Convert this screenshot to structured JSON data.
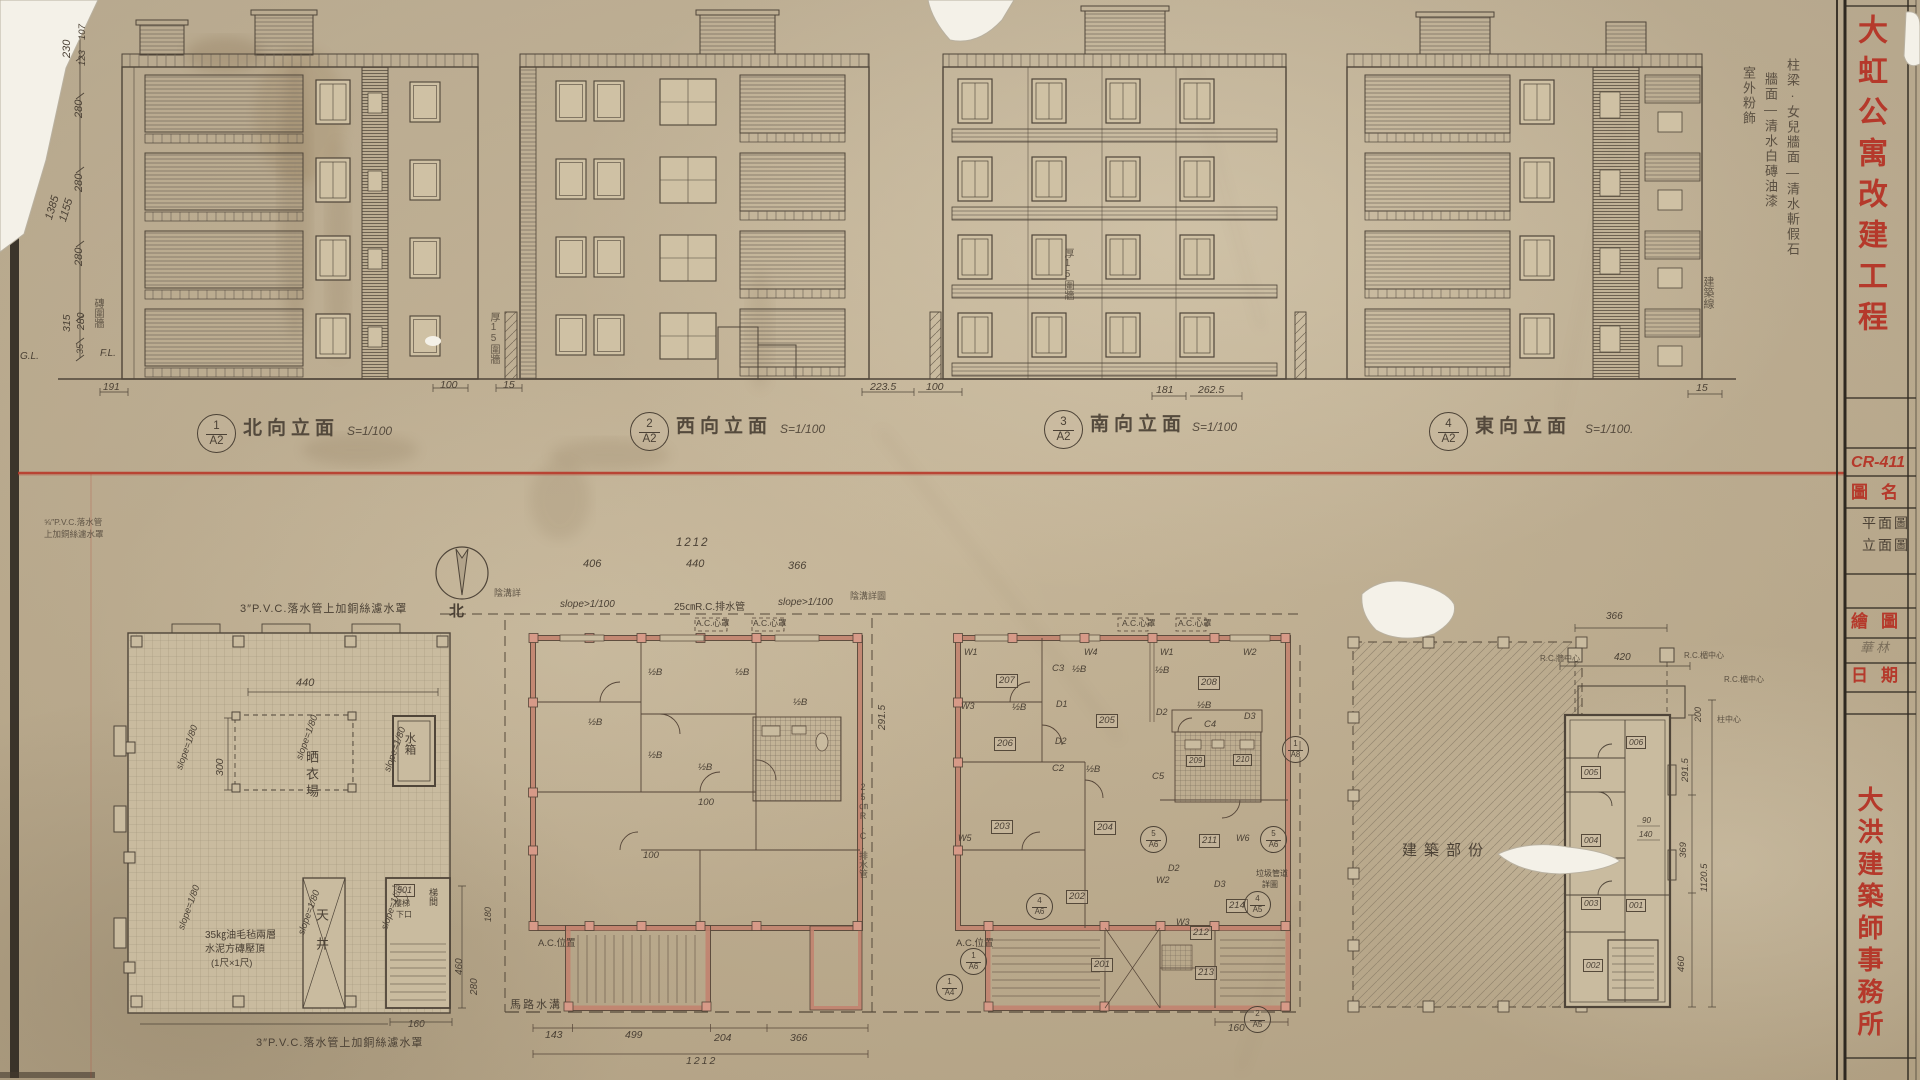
{
  "sheet": {
    "project_title": "大虹公寓改建工程",
    "firm_name": "大洪建築師事務所",
    "sheet_no": "CR-411",
    "title_block": {
      "drawing_name_label": "圖名",
      "drawing_name_line1": "平面圖",
      "drawing_name_line2": "立面圖",
      "drawn_by_label": "繪圖",
      "drawn_by_value": "華林",
      "date_label": "日期"
    }
  },
  "finish_note": {
    "col1": "柱梁·女兒牆面—清水斬假石",
    "col2": "牆面—清水白磚油漆",
    "col3": "室外粉飾"
  },
  "elevations": {
    "labels": [
      {
        "no": "1",
        "sheet": "A2",
        "title": "北向立面",
        "scale": "S=1/100"
      },
      {
        "no": "2",
        "sheet": "A2",
        "title": "西向立面",
        "scale": "S=1/100"
      },
      {
        "no": "3",
        "sheet": "A2",
        "title": "南向立面",
        "scale": "S=1/100"
      },
      {
        "no": "4",
        "sheet": "A2",
        "title": "東向立面",
        "scale": "S=1/100."
      }
    ],
    "left_dims": {
      "d230": "230",
      "d107": "107",
      "d123": "123",
      "d280": "280",
      "d1385": "1385",
      "d1155": "1155",
      "d315": "315",
      "d35": "35",
      "gl": "G.L.",
      "fl": "F.L.",
      "brick_wall": "磚圍牆",
      "d191": "191"
    },
    "ground_dims": {
      "d100": "100",
      "d15": "15",
      "d2235": "223.5",
      "d100b": "100",
      "d181": "181",
      "d2625": "262.5",
      "d15b": "15"
    },
    "notes": {
      "wall15": "厚15圍牆",
      "building_line": "建築線"
    }
  },
  "roof_plan": {
    "pvc_note": "3″P.V.C.落水管上加銅絲濾水罩",
    "pvc_note_s1": "⅝″P.V.C.落水管",
    "pvc_note_s2": "上加銅絲濾水罩",
    "slope": "slope=1/80",
    "d440": "440",
    "d300": "300",
    "d460": "460",
    "d280": "280",
    "d180": "180",
    "d160": "160",
    "drying": "晒衣場",
    "tank": "水箱",
    "lightwell": "天井",
    "stair_no": "501",
    "stair1": "樓梯",
    "stair2": "下口",
    "stair_room": "梯間",
    "note1": "35㎏油毛毡兩層",
    "note2": "水泥方磚壓頂",
    "note3": "(1尺×1尺)"
  },
  "plan_typ": {
    "north": "北",
    "d1212": "1212",
    "d406": "406",
    "d440": "440",
    "d366": "366",
    "slope": "slope>1/100",
    "drain": "25㎝R.C.排水管",
    "gutter": "陰溝詳圖",
    "gutter_s": "陰溝詳",
    "ac_hood": "A.C.心罩",
    "ac_pos": "A.C.位置",
    "half_b": "½B",
    "d100": "100",
    "road": "馬路水溝",
    "d143": "143",
    "d499": "499",
    "d204": "204",
    "d366b": "366",
    "d1212b": "1212",
    "d2915": "291.5"
  },
  "plan_unit": {
    "rooms": {
      "r201": "201",
      "r202": "202",
      "r203": "203",
      "r204": "204",
      "r205": "205",
      "r206": "206",
      "r207": "207",
      "r208": "208",
      "r209": "209",
      "r210": "210",
      "r211": "211",
      "r212": "212",
      "r213": "213",
      "r214": "214"
    },
    "w": {
      "w1": "W1",
      "w2": "W2",
      "w3": "W3",
      "w4": "W4",
      "w5": "W5",
      "w6": "W6"
    },
    "d": {
      "d1": "D1",
      "d2": "D2",
      "d3": "D3"
    },
    "c": {
      "c2": "C2",
      "c3": "C3",
      "c4": "C4",
      "c5": "C5"
    },
    "sec": {
      "s5a6": {
        "no": "5",
        "sheet": "A6"
      },
      "s4a6": {
        "no": "4",
        "sheet": "A6"
      },
      "s1a6": {
        "no": "1",
        "sheet": "A6"
      },
      "s1a4": {
        "no": "1",
        "sheet": "A4"
      },
      "s2a5": {
        "no": "2",
        "sheet": "A5"
      },
      "s4a5": {
        "no": "4",
        "sheet": "A5"
      },
      "s1a8": {
        "no": "1",
        "sheet": "A8"
      }
    },
    "garbage1": "垃圾管道",
    "garbage2": "詳圖",
    "ac_hood": "A.C.心罩",
    "ac_pos": "A.C.位置",
    "half_b": "½B",
    "d160": "160"
  },
  "demolish": {
    "label": "建築部份"
  },
  "end_unit": {
    "rooms": {
      "r001": "001",
      "r002": "002",
      "r003": "003",
      "r004": "004",
      "r005": "005",
      "r006": "006"
    },
    "d366": "366",
    "d420": "420",
    "d90": "90",
    "d140": "140",
    "d200": "200",
    "d2915": "291.5",
    "d369": "369",
    "d460": "460",
    "d11205": "1120.5",
    "wall_center": "R.C.牆中心",
    "lintel_center": "R.C.楣中心",
    "col_center": "柱中心"
  }
}
